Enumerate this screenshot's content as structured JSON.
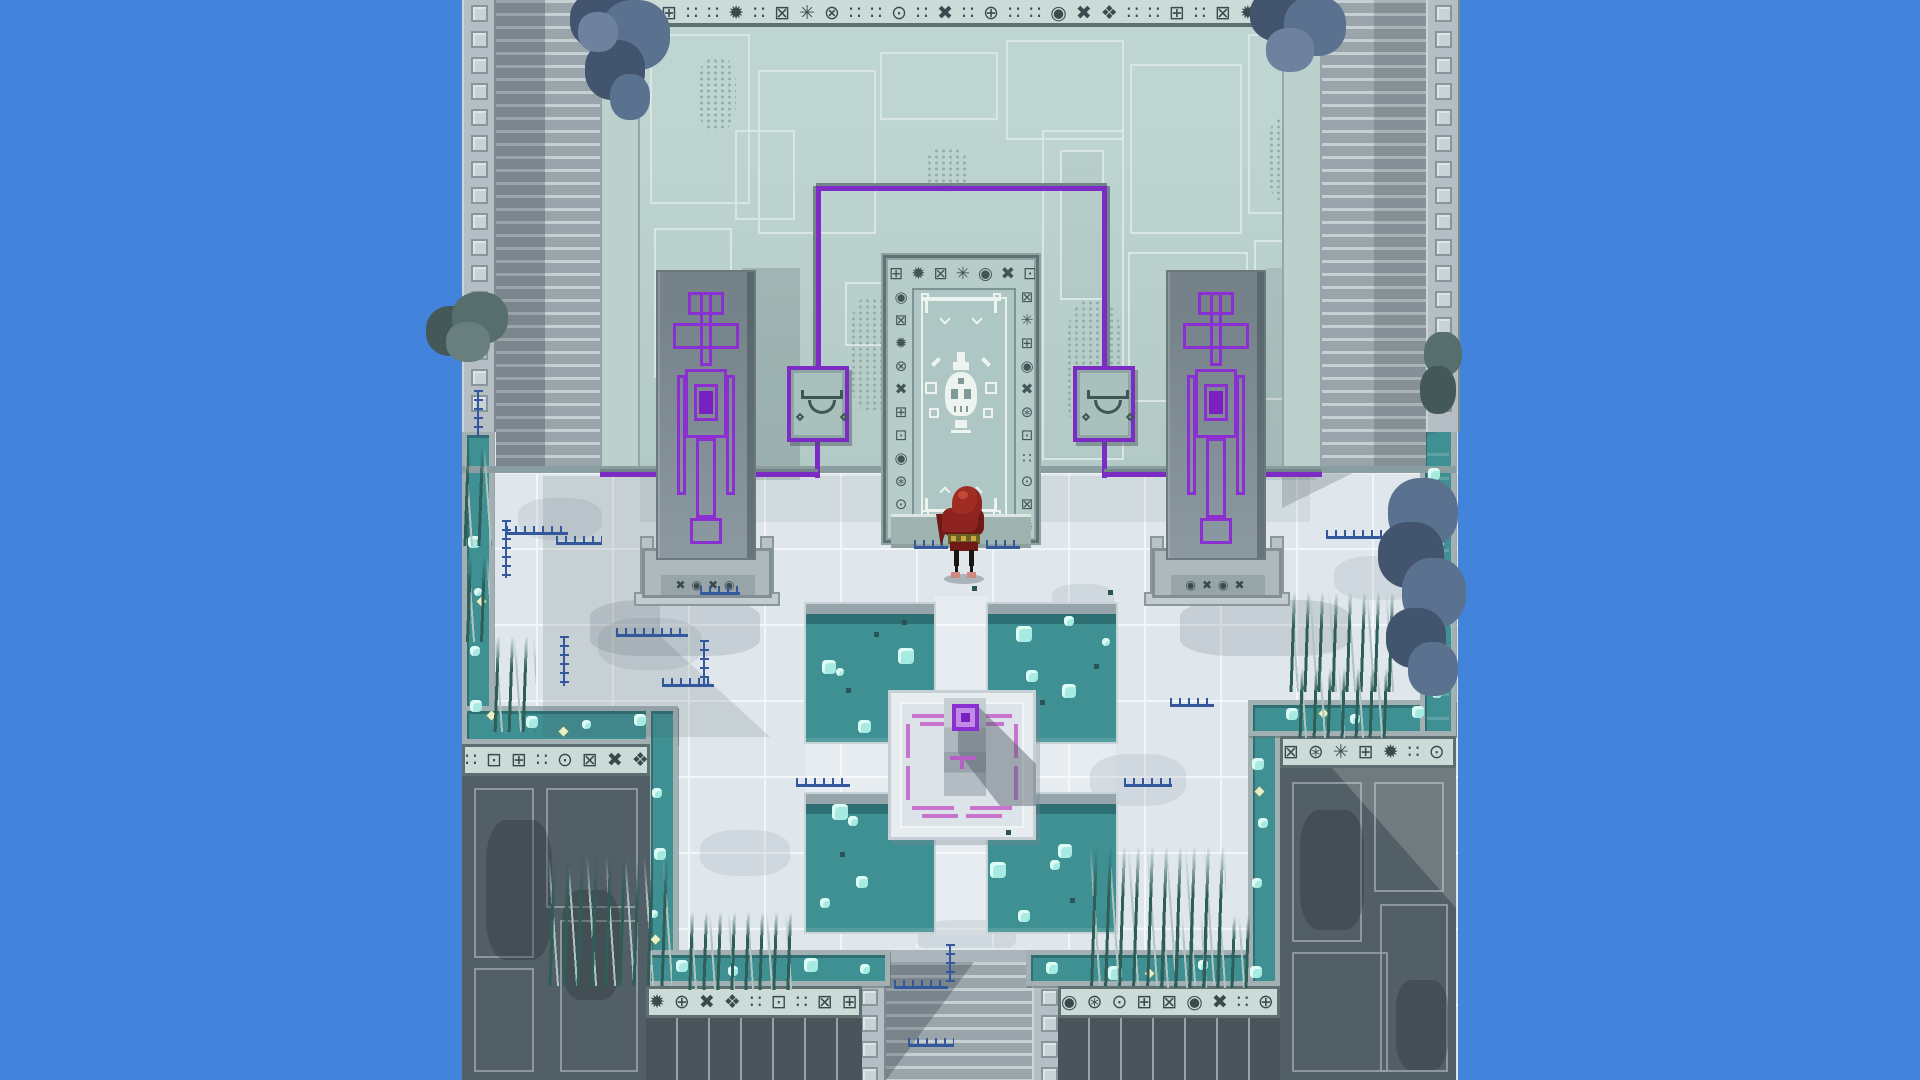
{
  "scene": {
    "description": "top-down pixel-art temple courtyard with skull door, purple banner monoliths, moat and pools"
  },
  "palette": {
    "sky": "#4284DB",
    "facade": "#B2C9C6",
    "facade_hi": "#BFD5D1",
    "panel_line": "#DAE6E3",
    "wall_seam": "#9FB4B1",
    "frieze_bg": "#CCDBD7",
    "glyph": "#3B4B4D",
    "frieze_edge": "#5E6F71",
    "stripe_a": "#9AA5AB",
    "stripe_b": "#C6D0D4",
    "flat_strip": "#BCD1CE",
    "pillar_bg": "#B4BEC4",
    "pillar_sq": "#C9D3D7",
    "pillar_line": "#8A959B",
    "floor": "#DFE7EC",
    "tile_line": "#F2F6F8",
    "water": "#3F9093",
    "water_dark": "#2D6F72",
    "rim": "#A2B0B4",
    "bubble": "#A7EAE2",
    "bubble_hi": "#DCFBF5",
    "pool_rim": "#96A5AB",
    "block_dark": "#535F66",
    "block_line": "#96A2A7",
    "block_deep": "#49545B",
    "purple": "#7C2CC4",
    "banner_purple": "#8B2FD0",
    "banner_core": "#7A1FC0",
    "pink": "#C873CE",
    "mono_slab": "#8C99A0",
    "mono_slab_dark": "#75828A",
    "base": "#ADB9BD",
    "skull_white": "#EDF3EE",
    "door_panel": "#AFC7C4",
    "door_frame": "#5E7374",
    "cloak": "#8E2420",
    "cloak_hi": "#A12C24",
    "cloak_deep": "#701A18",
    "belt": "#6B6226",
    "gold": "#C9A83C",
    "skin": "#D08A7E",
    "grass_dark": "#2F5D57",
    "grass_light": "#AFC3BF",
    "flower_blue": "#33589E",
    "flower_dot": "#E9EFC6",
    "tree_main": "#5A7190",
    "tree_dark": "#43556E",
    "tree_hi": "#6E82A0",
    "bush_teal": "#566E6C",
    "bush_teal_dark": "#445759",
    "moss": "#8FA7A3"
  },
  "friezes": {
    "top": "∷⊞∷∷✹∷⊠✳⊗∷∷⊙∷✖∷⊕∷∷◉✖❖∷∷⊞∷⊠✹∷⊡⊠",
    "block_a_left": "∷⊡⊞∷⊙⊠✖❖⊕",
    "block_a_right": "⊠⊛✳⊞✹∷⊙✖",
    "block_b_left": "✹⊕✖❖∷⊡∷⊠⊞⊙",
    "block_b_right": "◉⊛⊙⊞⊠◉✖∷⊕◉",
    "door_top": "⊞✹⊠✳◉✖⊡",
    "door_left": "◉⊠✹⊗✖⊞⊡◉⊛⊙⊞⊠",
    "door_right": "⊠✳⊞◉✖⊛⊡∷⊙⊠✹⊕",
    "base_left": "✖◉✖◉",
    "base_right": "◉✖◉✖"
  },
  "icons": [
    "skull-icon",
    "eye-icon"
  ],
  "decor": {
    "bubbles": [
      {
        "x": 822,
        "y": 660,
        "w": 14,
        "h": 14
      },
      {
        "x": 836,
        "y": 668,
        "w": 8,
        "h": 8
      },
      {
        "x": 898,
        "y": 648,
        "w": 16,
        "h": 16
      },
      {
        "x": 858,
        "y": 720,
        "w": 13,
        "h": 13
      },
      {
        "x": 1016,
        "y": 626,
        "w": 16,
        "h": 16
      },
      {
        "x": 1064,
        "y": 616,
        "w": 10,
        "h": 10
      },
      {
        "x": 1026,
        "y": 670,
        "w": 12,
        "h": 12
      },
      {
        "x": 1062,
        "y": 684,
        "w": 14,
        "h": 14
      },
      {
        "x": 1102,
        "y": 638,
        "w": 8,
        "h": 8
      },
      {
        "x": 832,
        "y": 804,
        "w": 16,
        "h": 16
      },
      {
        "x": 848,
        "y": 816,
        "w": 10,
        "h": 10
      },
      {
        "x": 856,
        "y": 876,
        "w": 12,
        "h": 12
      },
      {
        "x": 820,
        "y": 898,
        "w": 10,
        "h": 10
      },
      {
        "x": 990,
        "y": 862,
        "w": 16,
        "h": 16
      },
      {
        "x": 1058,
        "y": 844,
        "w": 14,
        "h": 14
      },
      {
        "x": 1050,
        "y": 860,
        "w": 10,
        "h": 10
      },
      {
        "x": 1018,
        "y": 910,
        "w": 12,
        "h": 12
      },
      {
        "x": 468,
        "y": 536,
        "w": 12,
        "h": 12
      },
      {
        "x": 474,
        "y": 588,
        "w": 8,
        "h": 8
      },
      {
        "x": 470,
        "y": 646,
        "w": 10,
        "h": 10
      },
      {
        "x": 470,
        "y": 700,
        "w": 12,
        "h": 12
      },
      {
        "x": 526,
        "y": 716,
        "w": 12,
        "h": 12
      },
      {
        "x": 582,
        "y": 720,
        "w": 9,
        "h": 9
      },
      {
        "x": 634,
        "y": 714,
        "w": 12,
        "h": 12
      },
      {
        "x": 652,
        "y": 788,
        "w": 10,
        "h": 10
      },
      {
        "x": 654,
        "y": 848,
        "w": 12,
        "h": 12
      },
      {
        "x": 650,
        "y": 910,
        "w": 8,
        "h": 8
      },
      {
        "x": 676,
        "y": 960,
        "w": 12,
        "h": 12
      },
      {
        "x": 728,
        "y": 966,
        "w": 10,
        "h": 10
      },
      {
        "x": 804,
        "y": 958,
        "w": 14,
        "h": 14
      },
      {
        "x": 860,
        "y": 964,
        "w": 10,
        "h": 10
      },
      {
        "x": 1046,
        "y": 962,
        "w": 12,
        "h": 12
      },
      {
        "x": 1108,
        "y": 966,
        "w": 14,
        "h": 14
      },
      {
        "x": 1198,
        "y": 960,
        "w": 10,
        "h": 10
      },
      {
        "x": 1250,
        "y": 966,
        "w": 12,
        "h": 12
      },
      {
        "x": 1252,
        "y": 758,
        "w": 12,
        "h": 12
      },
      {
        "x": 1258,
        "y": 818,
        "w": 10,
        "h": 10
      },
      {
        "x": 1252,
        "y": 878,
        "w": 10,
        "h": 10
      },
      {
        "x": 1286,
        "y": 708,
        "w": 12,
        "h": 12
      },
      {
        "x": 1350,
        "y": 714,
        "w": 10,
        "h": 10
      },
      {
        "x": 1412,
        "y": 706,
        "w": 12,
        "h": 12
      },
      {
        "x": 1428,
        "y": 468,
        "w": 12,
        "h": 12
      },
      {
        "x": 1434,
        "y": 538,
        "w": 10,
        "h": 10
      },
      {
        "x": 1426,
        "y": 638,
        "w": 12,
        "h": 12
      },
      {
        "x": 1432,
        "y": 688,
        "w": 10,
        "h": 10
      }
    ],
    "specks": [
      {
        "x": 846,
        "y": 688
      },
      {
        "x": 874,
        "y": 632
      },
      {
        "x": 1040,
        "y": 700
      },
      {
        "x": 1094,
        "y": 664
      },
      {
        "x": 840,
        "y": 852
      },
      {
        "x": 1006,
        "y": 830
      },
      {
        "x": 1070,
        "y": 898
      },
      {
        "x": 902,
        "y": 620
      },
      {
        "x": 972,
        "y": 586
      },
      {
        "x": 1108,
        "y": 590
      }
    ],
    "dotflowers": [
      {
        "x": 478,
        "y": 598
      },
      {
        "x": 488,
        "y": 712
      },
      {
        "x": 560,
        "y": 728
      },
      {
        "x": 652,
        "y": 936
      },
      {
        "x": 1146,
        "y": 970
      },
      {
        "x": 1256,
        "y": 788
      },
      {
        "x": 1320,
        "y": 710
      },
      {
        "x": 1430,
        "y": 600
      }
    ],
    "sprigs_h": [
      {
        "x": 506,
        "y": 526,
        "w": 62
      },
      {
        "x": 556,
        "y": 536,
        "w": 46
      },
      {
        "x": 616,
        "y": 628,
        "w": 72
      },
      {
        "x": 662,
        "y": 678,
        "w": 52
      },
      {
        "x": 914,
        "y": 540,
        "w": 34
      },
      {
        "x": 986,
        "y": 540,
        "w": 34
      },
      {
        "x": 796,
        "y": 778,
        "w": 54
      },
      {
        "x": 1124,
        "y": 778,
        "w": 48
      },
      {
        "x": 1326,
        "y": 530,
        "w": 74
      },
      {
        "x": 1170,
        "y": 698,
        "w": 44
      },
      {
        "x": 894,
        "y": 980,
        "w": 54
      },
      {
        "x": 908,
        "y": 1038,
        "w": 46
      },
      {
        "x": 700,
        "y": 586,
        "w": 40
      }
    ],
    "sprigs_v": [
      {
        "x": 502,
        "y": 520,
        "h": 58
      },
      {
        "x": 560,
        "y": 636,
        "h": 50
      },
      {
        "x": 700,
        "y": 640,
        "h": 44
      },
      {
        "x": 946,
        "y": 944,
        "h": 38
      },
      {
        "x": 474,
        "y": 390,
        "h": 46
      },
      {
        "x": 1408,
        "y": 560,
        "h": 40
      }
    ],
    "grass": [
      {
        "x": 462,
        "y": 446,
        "w": 30,
        "h": 100
      },
      {
        "x": 464,
        "y": 556,
        "w": 26,
        "h": 86
      },
      {
        "x": 492,
        "y": 636,
        "w": 44,
        "h": 96
      },
      {
        "x": 548,
        "y": 856,
        "w": 124,
        "h": 130
      },
      {
        "x": 686,
        "y": 912,
        "w": 110,
        "h": 78
      },
      {
        "x": 1090,
        "y": 846,
        "w": 136,
        "h": 140
      },
      {
        "x": 1158,
        "y": 916,
        "w": 100,
        "h": 72
      },
      {
        "x": 1288,
        "y": 592,
        "w": 112,
        "h": 100
      },
      {
        "x": 1296,
        "y": 668,
        "w": 100,
        "h": 70
      },
      {
        "x": 1424,
        "y": 556,
        "w": 28,
        "h": 90
      }
    ],
    "panels": [
      {
        "x": 650,
        "y": 34,
        "w": 100,
        "h": 170
      },
      {
        "x": 758,
        "y": 70,
        "w": 118,
        "h": 164
      },
      {
        "x": 880,
        "y": 52,
        "w": 118,
        "h": 68
      },
      {
        "x": 1006,
        "y": 40,
        "w": 118,
        "h": 100
      },
      {
        "x": 1130,
        "y": 64,
        "w": 112,
        "h": 170
      },
      {
        "x": 1248,
        "y": 34,
        "w": 58,
        "h": 180
      },
      {
        "x": 654,
        "y": 228,
        "w": 78,
        "h": 150
      },
      {
        "x": 845,
        "y": 282,
        "w": 38,
        "h": 64
      },
      {
        "x": 1042,
        "y": 130,
        "w": 82,
        "h": 330
      },
      {
        "x": 1128,
        "y": 252,
        "w": 120,
        "h": 150
      },
      {
        "x": 1254,
        "y": 240,
        "w": 52,
        "h": 160
      },
      {
        "x": 735,
        "y": 130,
        "w": 60,
        "h": 90
      },
      {
        "x": 1060,
        "y": 150,
        "w": 44,
        "h": 150,
        "cls": "dim"
      }
    ],
    "moss": [
      {
        "x": 850,
        "y": 298,
        "w": 42,
        "h": 112
      },
      {
        "x": 1066,
        "y": 300,
        "w": 56,
        "h": 136
      },
      {
        "x": 698,
        "y": 58,
        "w": 38,
        "h": 72
      },
      {
        "x": 926,
        "y": 148,
        "w": 42,
        "h": 44
      },
      {
        "x": 1268,
        "y": 118,
        "w": 32,
        "h": 82
      },
      {
        "x": 660,
        "y": 376,
        "w": 42,
        "h": 62
      },
      {
        "x": 470,
        "y": 250,
        "w": 24,
        "h": 120
      },
      {
        "x": 1330,
        "y": 80,
        "w": 26,
        "h": 90
      }
    ],
    "stains": [
      {
        "x": 598,
        "y": 618,
        "w": 104,
        "h": 52
      },
      {
        "x": 916,
        "y": 920,
        "w": 100,
        "h": 34
      },
      {
        "x": 1090,
        "y": 754,
        "w": 96,
        "h": 52
      },
      {
        "x": 518,
        "y": 498,
        "w": 84,
        "h": 42
      },
      {
        "x": 1334,
        "y": 556,
        "w": 92,
        "h": 44
      },
      {
        "x": 1052,
        "y": 584,
        "w": 62,
        "h": 28
      },
      {
        "x": 700,
        "y": 830,
        "w": 90,
        "h": 46
      }
    ],
    "darkpanels": [
      {
        "x": 474,
        "y": 788,
        "w": 60,
        "h": 170
      },
      {
        "x": 474,
        "y": 968,
        "w": 60,
        "h": 104
      },
      {
        "x": 546,
        "y": 788,
        "w": 92,
        "h": 120
      },
      {
        "x": 560,
        "y": 920,
        "w": 78,
        "h": 152
      },
      {
        "x": 1292,
        "y": 782,
        "w": 70,
        "h": 160
      },
      {
        "x": 1374,
        "y": 782,
        "w": 70,
        "h": 110
      },
      {
        "x": 1292,
        "y": 952,
        "w": 96,
        "h": 120
      },
      {
        "x": 1380,
        "y": 904,
        "w": 68,
        "h": 168
      }
    ],
    "blockstains": [
      {
        "x": 486,
        "y": 820,
        "w": 66,
        "h": 140
      },
      {
        "x": 562,
        "y": 890,
        "w": 58,
        "h": 110
      },
      {
        "x": 1300,
        "y": 810,
        "w": 64,
        "h": 120
      },
      {
        "x": 1396,
        "y": 980,
        "w": 52,
        "h": 90
      }
    ]
  }
}
